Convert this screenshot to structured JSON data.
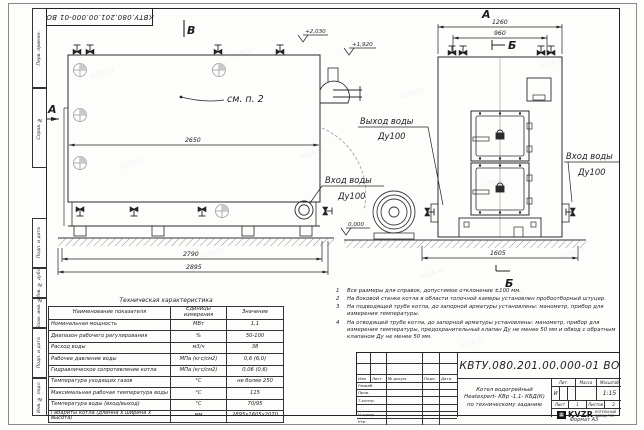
{
  "watermark": "KVZR.kz",
  "stamp_top": "КВТУ.080.201.00.000-01 ВО",
  "margin": {
    "labels": [
      "Перв. примен.",
      "Справ. №",
      "Подп. и дата",
      "Инв. № дубл.",
      "Взам. инв. №",
      "Подп. и дата",
      "Инв. № подл."
    ]
  },
  "drawing": {
    "section_b_top": "В",
    "section_a_left": "А",
    "view_a_label": "А",
    "section_b_right": "Б",
    "section_b_bottom": "Б",
    "note_ref": "см. п. 2",
    "elev_1": "+2,030",
    "elev_2": "+1,920",
    "elev_zero": "0,000",
    "dim_2650": "2650",
    "dim_2790": "2790",
    "dim_2895": "2895",
    "dim_1260": "1260",
    "dim_960": "960",
    "dim_1605": "1605",
    "outlet_line1": "Выход воды",
    "outlet_line2": "Ду100",
    "inlet_left_line1": "Вход воды",
    "inlet_left_line2": "Ду100",
    "inlet_right_line1": "Вход воды",
    "inlet_right_line2": "Ду100"
  },
  "tech_table": {
    "title": "Техническая характеристика",
    "headers": [
      "Наименование показателя",
      "Единицы измерения",
      "Значение"
    ],
    "rows": [
      {
        "name": "Номинальная мощность",
        "unit": "МВт",
        "value": "1,1"
      },
      {
        "name": "Диапазон рабочего регулирования",
        "unit": "%",
        "value": "50-100"
      },
      {
        "name": "Расход воды",
        "unit": "м3/ч",
        "value": "38"
      },
      {
        "name": "Рабочее давление воды",
        "unit": "МПа (кгс/см2)",
        "value": "0,6 (6,0)"
      },
      {
        "name": "Гидравлическое сопротивление котла",
        "unit": "МПа (кгс/см2)",
        "value": "0,06 (0,6)"
      },
      {
        "name": "Температура уходящих газов",
        "unit": "°С",
        "value": "не более 250"
      },
      {
        "name": "Максимальная рабочая температура воды",
        "unit": "°С",
        "value": "115"
      },
      {
        "name": "Температура воды (вход/выход)",
        "unit": "°С",
        "value": "70/95"
      },
      {
        "name": "Габариты котла (длинна х ширина х высота)",
        "unit": "мм",
        "value": "2895х1605х2070"
      }
    ]
  },
  "notes": {
    "items": [
      {
        "num": "1",
        "text": "Все размеры для справок, допустимое отклонение ±100 мм."
      },
      {
        "num": "2",
        "text": "На боковой стенке котла в области топочной камеры установлен пробоотборный штуцер."
      },
      {
        "num": "3",
        "text": "На подводящей трубе котла, до запорной арматуры установлены: манометр, прибор для измерения температуры."
      },
      {
        "num": "4",
        "text": "На отводящей трубе котла, до запорной арматуры установлены: манометр, прибор для измерения температуры, предохранительный клапан Ду не менее 50 мм и обвод с обратным клапаном Ду не менее 50 мм."
      }
    ]
  },
  "title_block": {
    "designation": "КВТУ.080.201.00.000-01 ВО",
    "title_line1": "Котел водогрейный",
    "title_line2": "Heatexpert- КВр -1,1- КБД(К)",
    "title_line3": "по техническому заданию",
    "col_izm": "Изм",
    "col_list": "Лист",
    "col_doc": "№ докум.",
    "col_podp": "Подп.",
    "col_data": "Дата",
    "row_razrab": "Разраб.",
    "row_prov": "Пров.",
    "row_tkontr": "Т.контр.",
    "row_nkontr": "Н.контр.",
    "row_utv": "Утв.",
    "lit_label": "Лит.",
    "lit_value": "И",
    "mass_label": "Масса",
    "scale_label": "Масштаб",
    "scale_value": "1:15",
    "sheet_label": "Лист",
    "sheet_value": "1",
    "sheets_label": "Листов",
    "sheets_value": "2",
    "company_name": "KVZR",
    "company_sub1": "КОТЕЛЬНЫЙ",
    "company_sub2": "ЗАВОД РЭП"
  },
  "format_label": "Формат  А3"
}
